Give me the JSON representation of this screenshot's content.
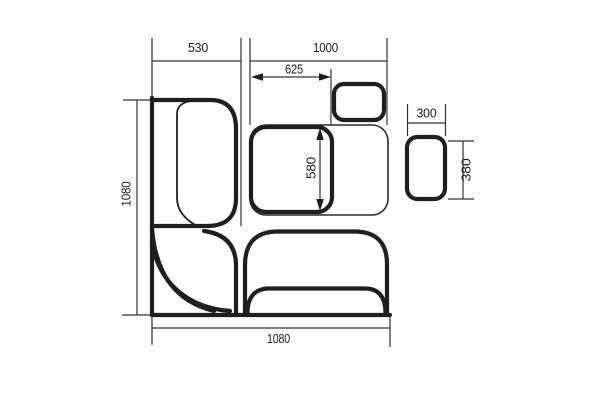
{
  "drawing": {
    "kind": "corner-bench-dining-set-plan",
    "labels": {
      "bench_left_width": "530",
      "bench_bottom_length": "1000",
      "table_width": "625",
      "table_depth": "580",
      "overall_depth_left": "1080",
      "overall_width_bottom": "1080",
      "stool_width": "300",
      "stool_depth": "380"
    },
    "colors": {
      "line": "#1f1f1f",
      "thin_line": "#333333",
      "background": "#ffffff",
      "edge_shade": "#e7e7e7"
    }
  }
}
